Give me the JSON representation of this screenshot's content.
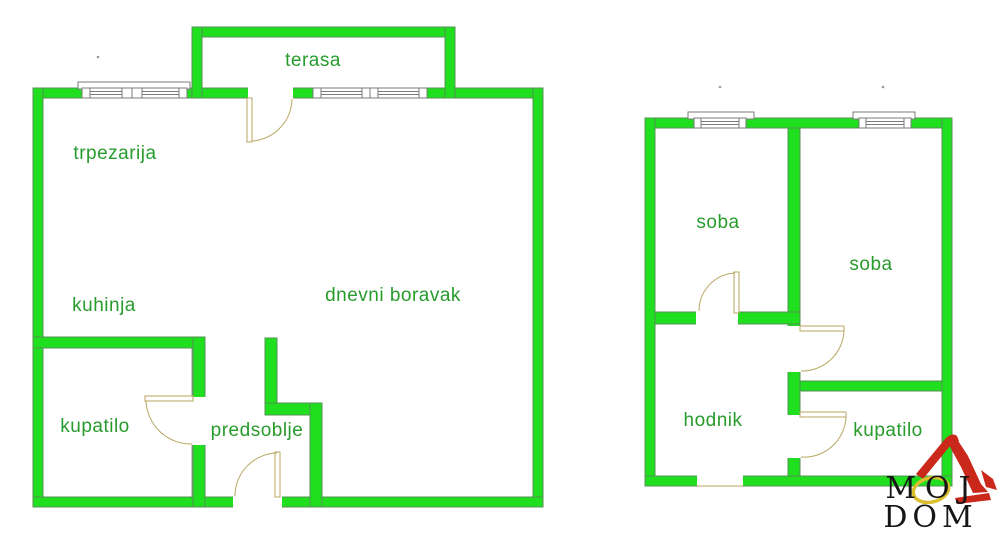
{
  "colors": {
    "wall": "#1fdf1f",
    "wall_border": "#569056",
    "outline": "#8a9e8a",
    "door": "#b8a662",
    "label": "#289b2d",
    "logo_red": "#c9281a",
    "logo_yellow": "#dcbf2e",
    "logo_text": "#161616"
  },
  "plans": {
    "left": {
      "terrace_label": "terasa",
      "dining_label": "trpezarija",
      "kitchen_label": "kuhinja",
      "living_label": "dnevni boravak",
      "bathroom_label": "kupatilo",
      "hallway_label": "predsoblje"
    },
    "right": {
      "room1_label": "soba",
      "room2_label": "soba",
      "corridor_label": "hodnik",
      "bathroom_label": "kupatilo"
    }
  },
  "logo": {
    "line1": "MOJ",
    "line2": "DOM"
  }
}
